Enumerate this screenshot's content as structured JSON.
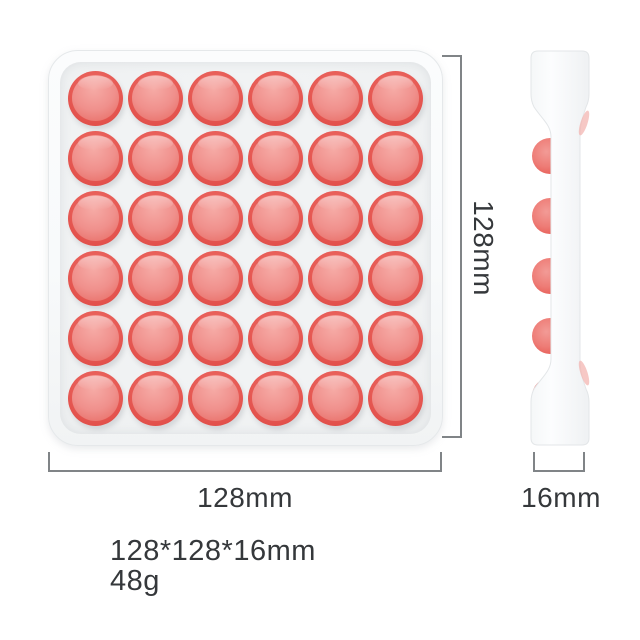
{
  "product": {
    "name": "Square pop-it bubble fidget tray, red on white",
    "front_view": {
      "rows": 6,
      "cols": 6
    },
    "side_view": {
      "bumps": 6
    }
  },
  "colors": {
    "bubble_rim": "#e2504b",
    "bubble_rim_light": "#ee6e67",
    "bubble_dome": "#f0908c",
    "bubble_dome_light": "#f6aba6",
    "bubble_dome_dark": "#e6605a",
    "tray_rim": "#f8fafb",
    "tray_surface": "#eef0f1",
    "dimension_line": "#808487",
    "text": "#35383b"
  },
  "annotations": {
    "width_label": "128mm",
    "height_label": "128mm",
    "depth_label": "16mm"
  },
  "specs": {
    "size_line": "128*128*16mm",
    "weight_line": "48g"
  }
}
